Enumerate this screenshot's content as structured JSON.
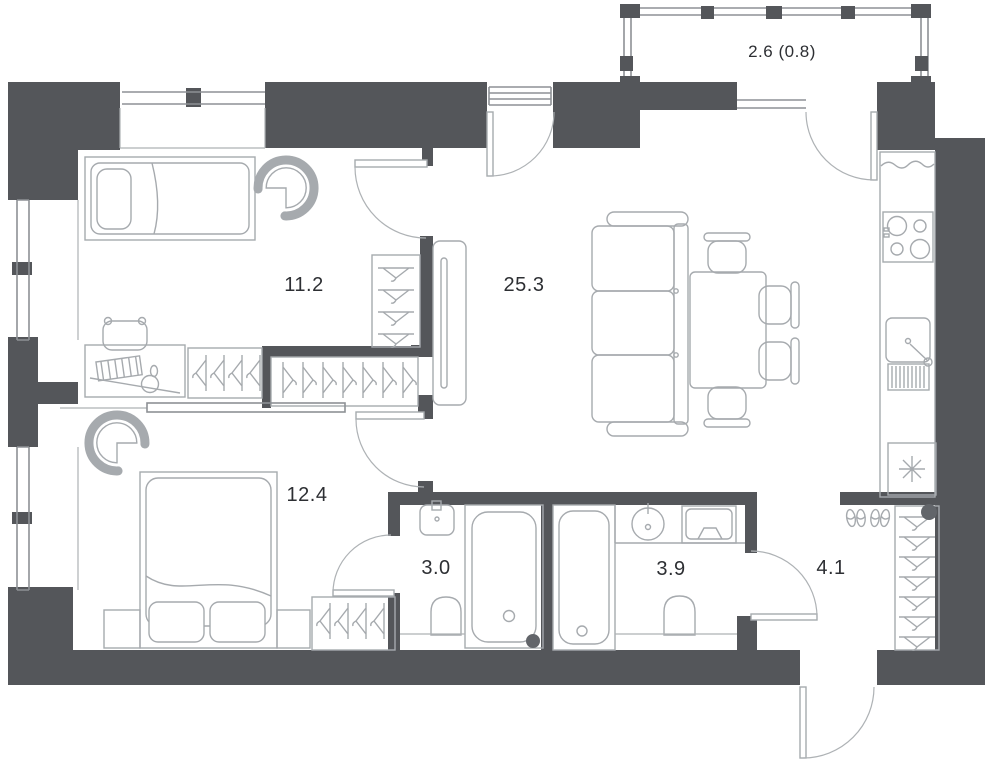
{
  "plan": {
    "title": "apartment-floor-plan",
    "rooms": [
      {
        "name": "bedroom-1",
        "area_label": "11.2",
        "furniture": [
          "single-bed",
          "armchair",
          "desk",
          "desk-chair",
          "wardrobe-hangers",
          "side-wardrobe"
        ]
      },
      {
        "name": "living-room",
        "area_label": "25.3",
        "furniture": [
          "tv-console",
          "sofa",
          "dining-table",
          "chairs",
          "kitchen-counter",
          "stove",
          "kitchen-sink",
          "fridge"
        ]
      },
      {
        "name": "bedroom-2",
        "area_label": "12.4",
        "furniture": [
          "double-bed",
          "pillows",
          "nightstands",
          "armchair",
          "wardrobe-hangers"
        ]
      },
      {
        "name": "bathroom-1",
        "area_label": "3.0",
        "furniture": [
          "washbasin",
          "toilet",
          "bathtub"
        ]
      },
      {
        "name": "bathroom-2",
        "area_label": "3.9",
        "furniture": [
          "bathtub",
          "round-sink",
          "washing-machine",
          "toilet"
        ]
      },
      {
        "name": "hallway",
        "area_label": "4.1",
        "furniture": [
          "shoes",
          "wardrobe-hangers",
          "entrance-door"
        ]
      },
      {
        "name": "balcony",
        "area_label": "2.6 (0.8)",
        "furniture": []
      }
    ],
    "colors": {
      "wall": "#54565a",
      "furniture_line": "#a6aaae",
      "thin_line": "#8d9195",
      "label_text": "#2d2f33",
      "background": "#ffffff",
      "riser_dot": "#62656a"
    }
  }
}
